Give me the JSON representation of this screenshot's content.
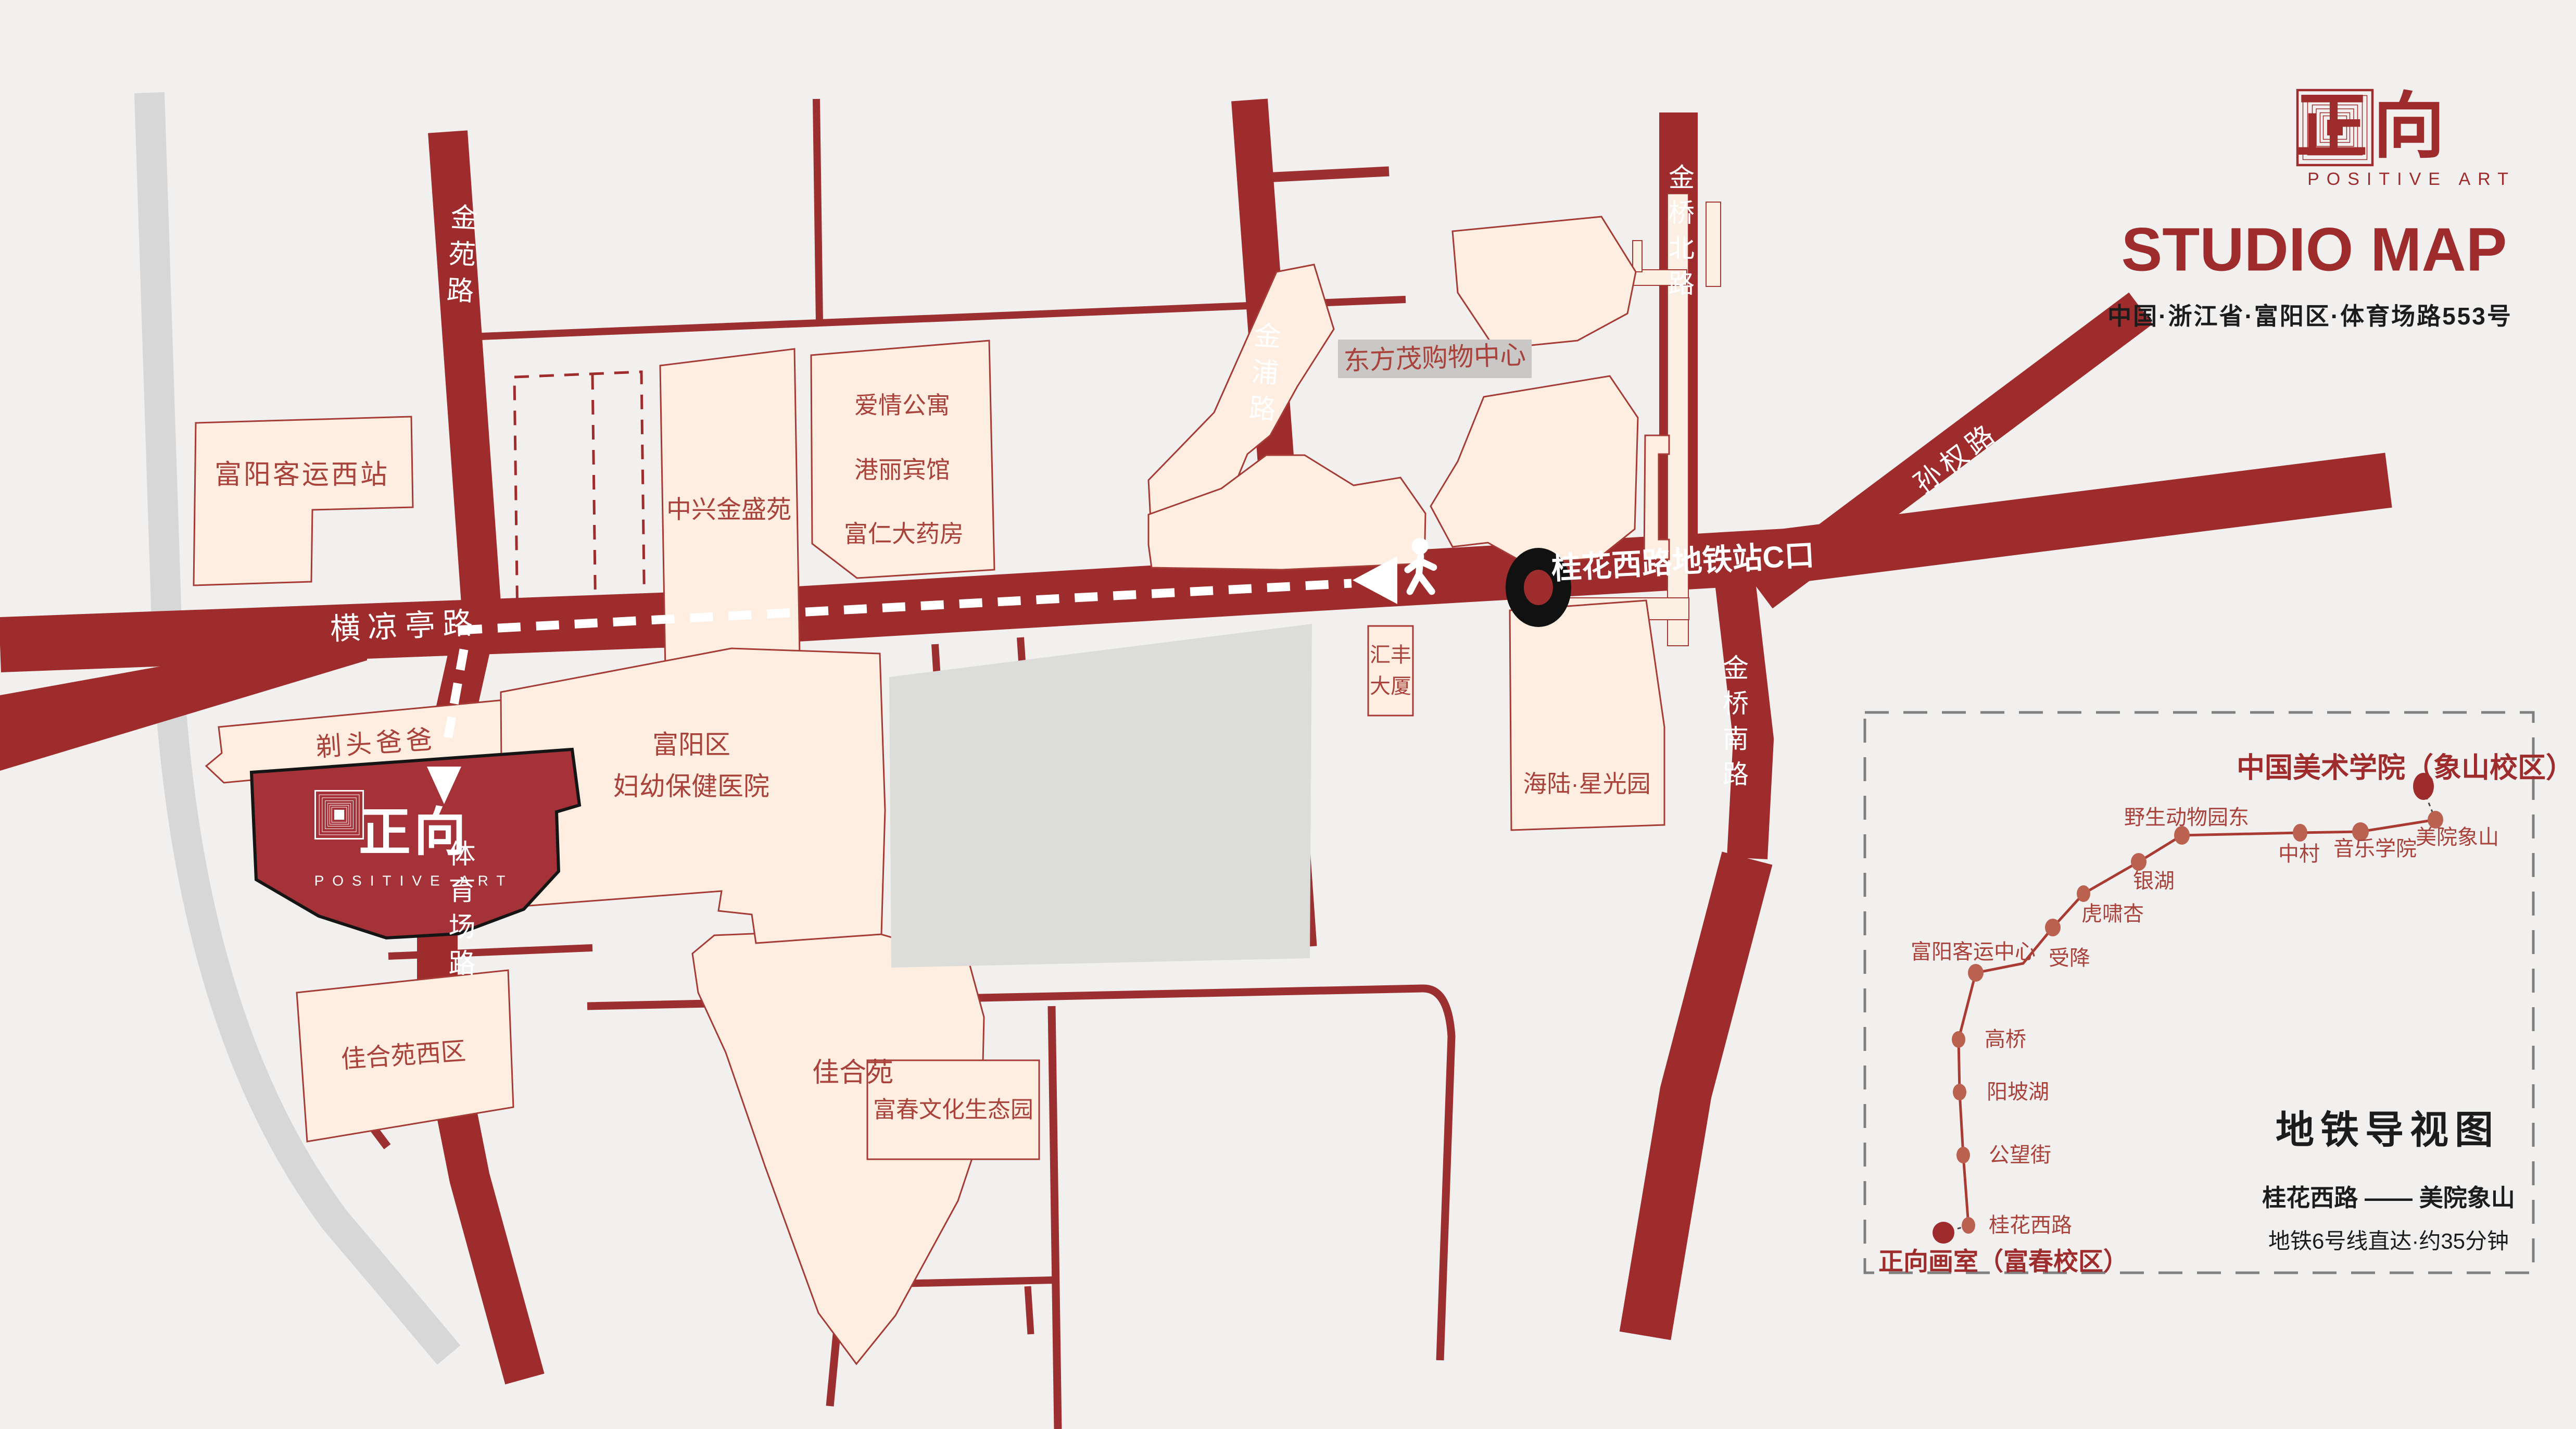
{
  "header": {
    "brand_cn": "正向",
    "brand_en": "POSITIVE ART",
    "title": "STUDIO MAP",
    "address": "中国·浙江省·富阳区·体育场路553号"
  },
  "map": {
    "road_labels": [
      {
        "name": "金苑路"
      },
      {
        "name": "金浦路"
      },
      {
        "name": "金桥北路"
      },
      {
        "name": "金桥南路"
      },
      {
        "name": "孙权路"
      },
      {
        "name": "横凉亭路"
      },
      {
        "name": "体育场路"
      }
    ],
    "route": {
      "exit_label": "桂花西路地铁站C口"
    },
    "building_labels": [
      {
        "name": "富阳客运西站"
      },
      {
        "name": "中兴金盛苑"
      },
      {
        "name": "爱情公寓"
      },
      {
        "name": "港丽宾馆"
      },
      {
        "name": "富仁大药房"
      },
      {
        "name": "东方茂购物中心"
      },
      {
        "name": "汇丰\n大厦"
      },
      {
        "name": "海陆·星光园"
      },
      {
        "name": "富阳区\n妇幼保健医院"
      },
      {
        "name": "剃头爸爸"
      },
      {
        "name": "佳合苑西区"
      },
      {
        "name": "佳合苑"
      },
      {
        "name": "富春文化生态园"
      }
    ],
    "studio": {
      "logo_cn": "正向",
      "logo_en": "POSITIVE ART"
    }
  },
  "metro": {
    "panel_title": "地铁导视图",
    "origin": "正向画室（富春校区）",
    "destination": "中国美术学院（象山校区）",
    "route_summary": "桂花西路 —— 美院象山",
    "note": "地铁6号线直达·约35分钟",
    "stations": [
      {
        "name": "桂花西路"
      },
      {
        "name": "公望街"
      },
      {
        "name": "阳坡湖"
      },
      {
        "name": "高桥"
      },
      {
        "name": "富阳客运中心"
      },
      {
        "name": "受降"
      },
      {
        "name": "虎啸杏"
      },
      {
        "name": "银湖"
      },
      {
        "name": "野生动物园东"
      },
      {
        "name": "中村"
      },
      {
        "name": "音乐学院"
      },
      {
        "name": "美院象山"
      }
    ]
  },
  "colors": {
    "road_red": "#9e2c2c",
    "building_fill": "#fdeee1",
    "studio_red": "#a43238",
    "background": "#f1f0ef",
    "metro_line": "#a93b33",
    "station_dot": "#bb6150",
    "marker_black": "#111111"
  }
}
